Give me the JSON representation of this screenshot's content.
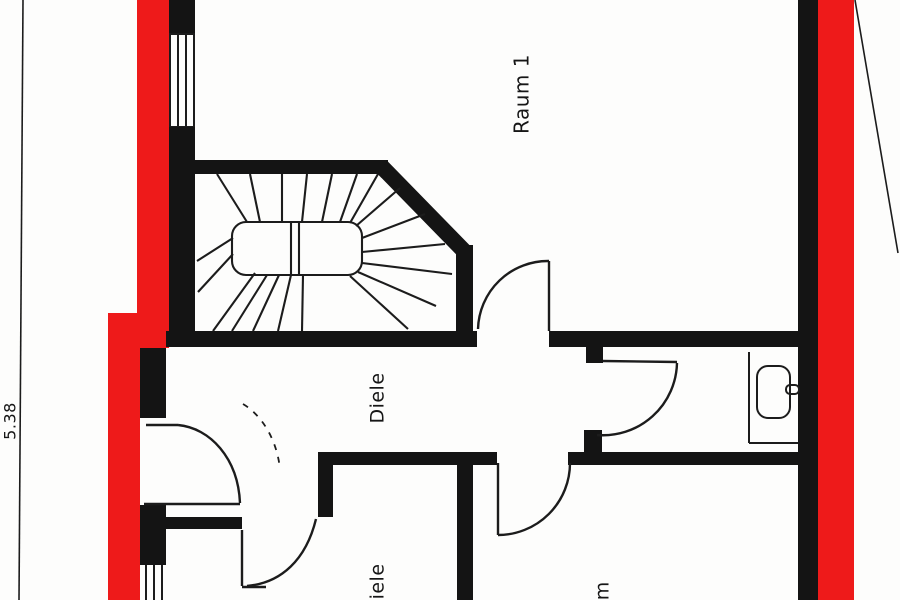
{
  "document": {
    "kind": "architectural floor plan scan",
    "floor_labels": [
      "Raum 1",
      "Diele",
      "Diele",
      "um"
    ],
    "dimension_text": "5.38"
  },
  "colors": {
    "wall": "#141414",
    "red": "#ee1a1a",
    "line": "#1c1c1c",
    "background": "#fdfdfc"
  },
  "labels": [
    {
      "id": "raum-1",
      "text": "Raum 1",
      "x": 523,
      "y": 94,
      "rotation": -90,
      "size": 20
    },
    {
      "id": "diele-center",
      "text": "Diele",
      "x": 378,
      "y": 398,
      "rotation": -90,
      "size": 19
    },
    {
      "id": "diele-bottom",
      "text": "Diele",
      "x": 378,
      "y": 589,
      "rotation": -90,
      "size": 19
    },
    {
      "id": "raum-partial",
      "text": "um",
      "x": 603,
      "y": 597,
      "rotation": -90,
      "size": 19
    },
    {
      "id": "dimension-5-38",
      "text": "5.38",
      "x": 11,
      "y": 421,
      "rotation": -90,
      "size": 16
    }
  ],
  "fixtures": [
    {
      "id": "sink",
      "name": "washbasin"
    }
  ],
  "features": {
    "windows": 2,
    "doors": 5,
    "stairs": "winder staircase",
    "highlighted_walls_color": "#ee1a1a"
  }
}
